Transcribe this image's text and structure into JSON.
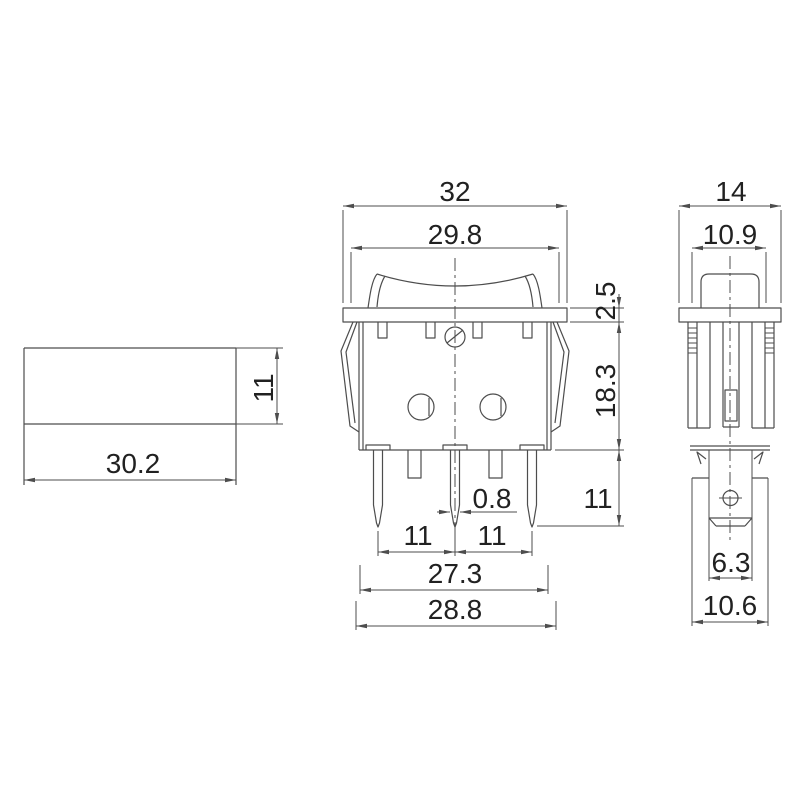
{
  "colors": {
    "background": "#ffffff",
    "line": "#4d4d4d",
    "text": "#212121"
  },
  "drawing_type": "rocker-switch-3-view-dimension-drawing",
  "views": {
    "cutout": {
      "width": "30.2",
      "height": "11"
    },
    "front": {
      "overall_width": "32",
      "bezel_inner_width": "29.8",
      "bezel_thickness": "2.5",
      "body_height": "18.3",
      "terminal_length": "11",
      "terminal_thickness": "0.8",
      "terminal_pitch_left": "11",
      "terminal_pitch_right": "11",
      "lower_body_width": "27.3",
      "upper_body_width": "28.8"
    },
    "side": {
      "overall_depth": "14",
      "bezel_inner_depth": "10.9",
      "terminal_blade_width": "6.3",
      "body_depth": "10.6"
    }
  }
}
